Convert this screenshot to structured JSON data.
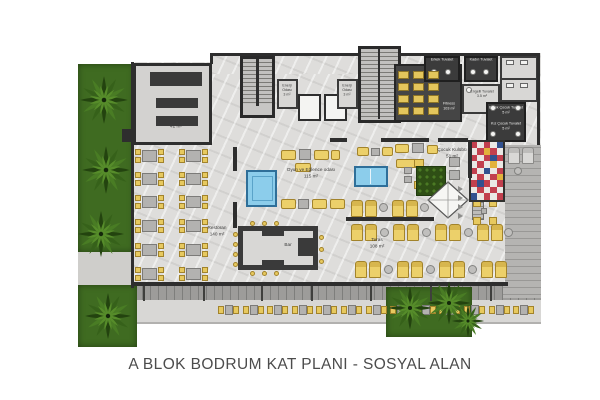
{
  "caption": "A BLOK BODRUM KAT PLANI - SOSYAL ALAN",
  "rooms": {
    "mutfak": {
      "name": "Mutfak",
      "area": "42 m²"
    },
    "enerji_odasi_1": {
      "name": "Enerji Odası",
      "area": "3 m²"
    },
    "enerji_odasi_2": {
      "name": "Enerji Odası",
      "area": "3 m²"
    },
    "fitness": {
      "name": "Fitness",
      "area": "103 m²"
    },
    "erkek_tuvalet": {
      "name": "Erkek Tuvalet"
    },
    "kadin_tuvalet": {
      "name": "Kadın Tuvalet"
    },
    "engelli_tuvalet": {
      "name": "Engelli Tuvalet",
      "area": "3.5 m²"
    },
    "erkek_cocuk_tuvalet": {
      "name": "Erkek Çocuk Tuvalet",
      "area": "5 m²"
    },
    "kiz_cocuk_tuvalet": {
      "name": "Kız Çocuk Tuvalet",
      "area": "5 m²"
    },
    "oyun_eglence": {
      "name": "Oyun ve Eğlence odası",
      "area": "115 m²"
    },
    "cocuk_kulubu": {
      "name": "Çocuk Kulübü",
      "area": "51 m²"
    },
    "restoran": {
      "name": "Restoran",
      "area": "140 m²"
    },
    "bar": {
      "name": "Bar"
    },
    "teras": {
      "name": "Teras",
      "area": "108 m²"
    }
  },
  "colors": {
    "grass": "#3f6b21",
    "floor": "#dedddb",
    "wall": "#2e2e2e",
    "dark_room": "#454545",
    "furniture_yellow": "#e7c95f",
    "furniture_gray": "#b3b2b0",
    "pool_blue": "#8ccdeb",
    "play_mat_red": "#c2404e",
    "deck": "#9d9c9a",
    "caption_text": "#4c4c4c"
  }
}
